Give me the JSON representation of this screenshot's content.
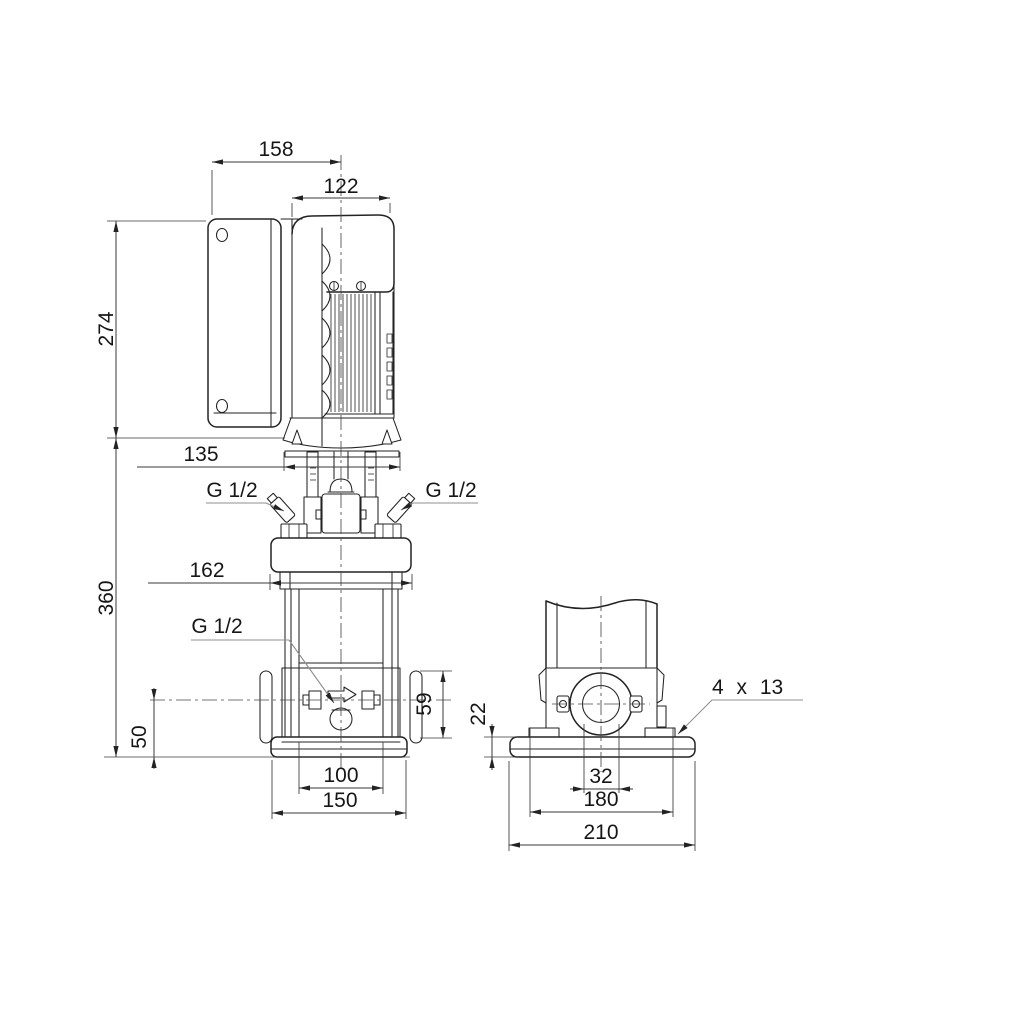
{
  "page": {
    "background_color": "#ffffff",
    "line_color": "#232323",
    "drawing_type": "pump dimensional drawing"
  },
  "front_view": {
    "dim_total_width": "158",
    "dim_motor_width": "122",
    "dim_motor_height": "274",
    "dim_adapter_width": "135",
    "dim_total_height": "360",
    "dim_head_width": "162",
    "dim_port_center_height": "50",
    "dim_flange_height": "59",
    "dim_chamber_diameter": "100",
    "dim_base_width": "150",
    "label_gauge_port_left": "G 1/2",
    "label_gauge_port_right": "G 1/2",
    "label_drain_port": "G 1/2"
  },
  "side_view": {
    "dim_base_height": "22",
    "dim_port_bore": "32",
    "dim_bolt_hole_spacing": "180",
    "dim_base_depth": "210",
    "label_mounting_holes": "4 x 13"
  }
}
